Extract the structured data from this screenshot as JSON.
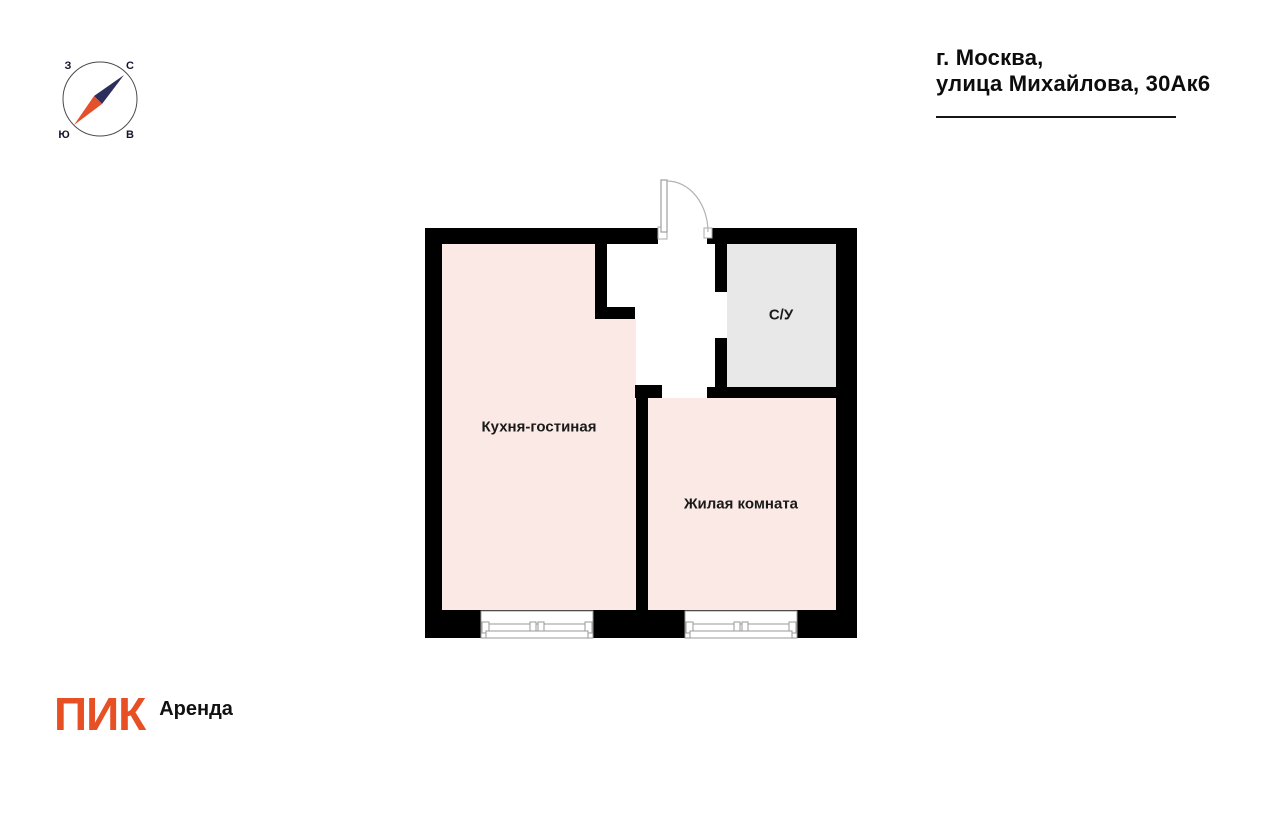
{
  "header": {
    "address_line1": "г. Москва,",
    "address_line2": "улица Михайлова, 30Ак6"
  },
  "compass": {
    "label_west": "З",
    "label_north": "С",
    "label_south": "Ю",
    "label_east": "В"
  },
  "floorplan": {
    "rooms": {
      "kitchen_living": {
        "label": "Кухня-гостиная"
      },
      "living_room": {
        "label": "Жилая комната"
      },
      "bathroom": {
        "label": "С/У"
      }
    }
  },
  "footer": {
    "logo_text": "ПИК",
    "brand_suffix": "Аренда"
  },
  "colors": {
    "wall_color": "#000000",
    "room_pink": "#FAE9E4",
    "room_gray": "#E8E8E8",
    "logo_orange": "#E75025",
    "needle_navy": "#2C2F5B",
    "needle_orange": "#E4502C"
  }
}
